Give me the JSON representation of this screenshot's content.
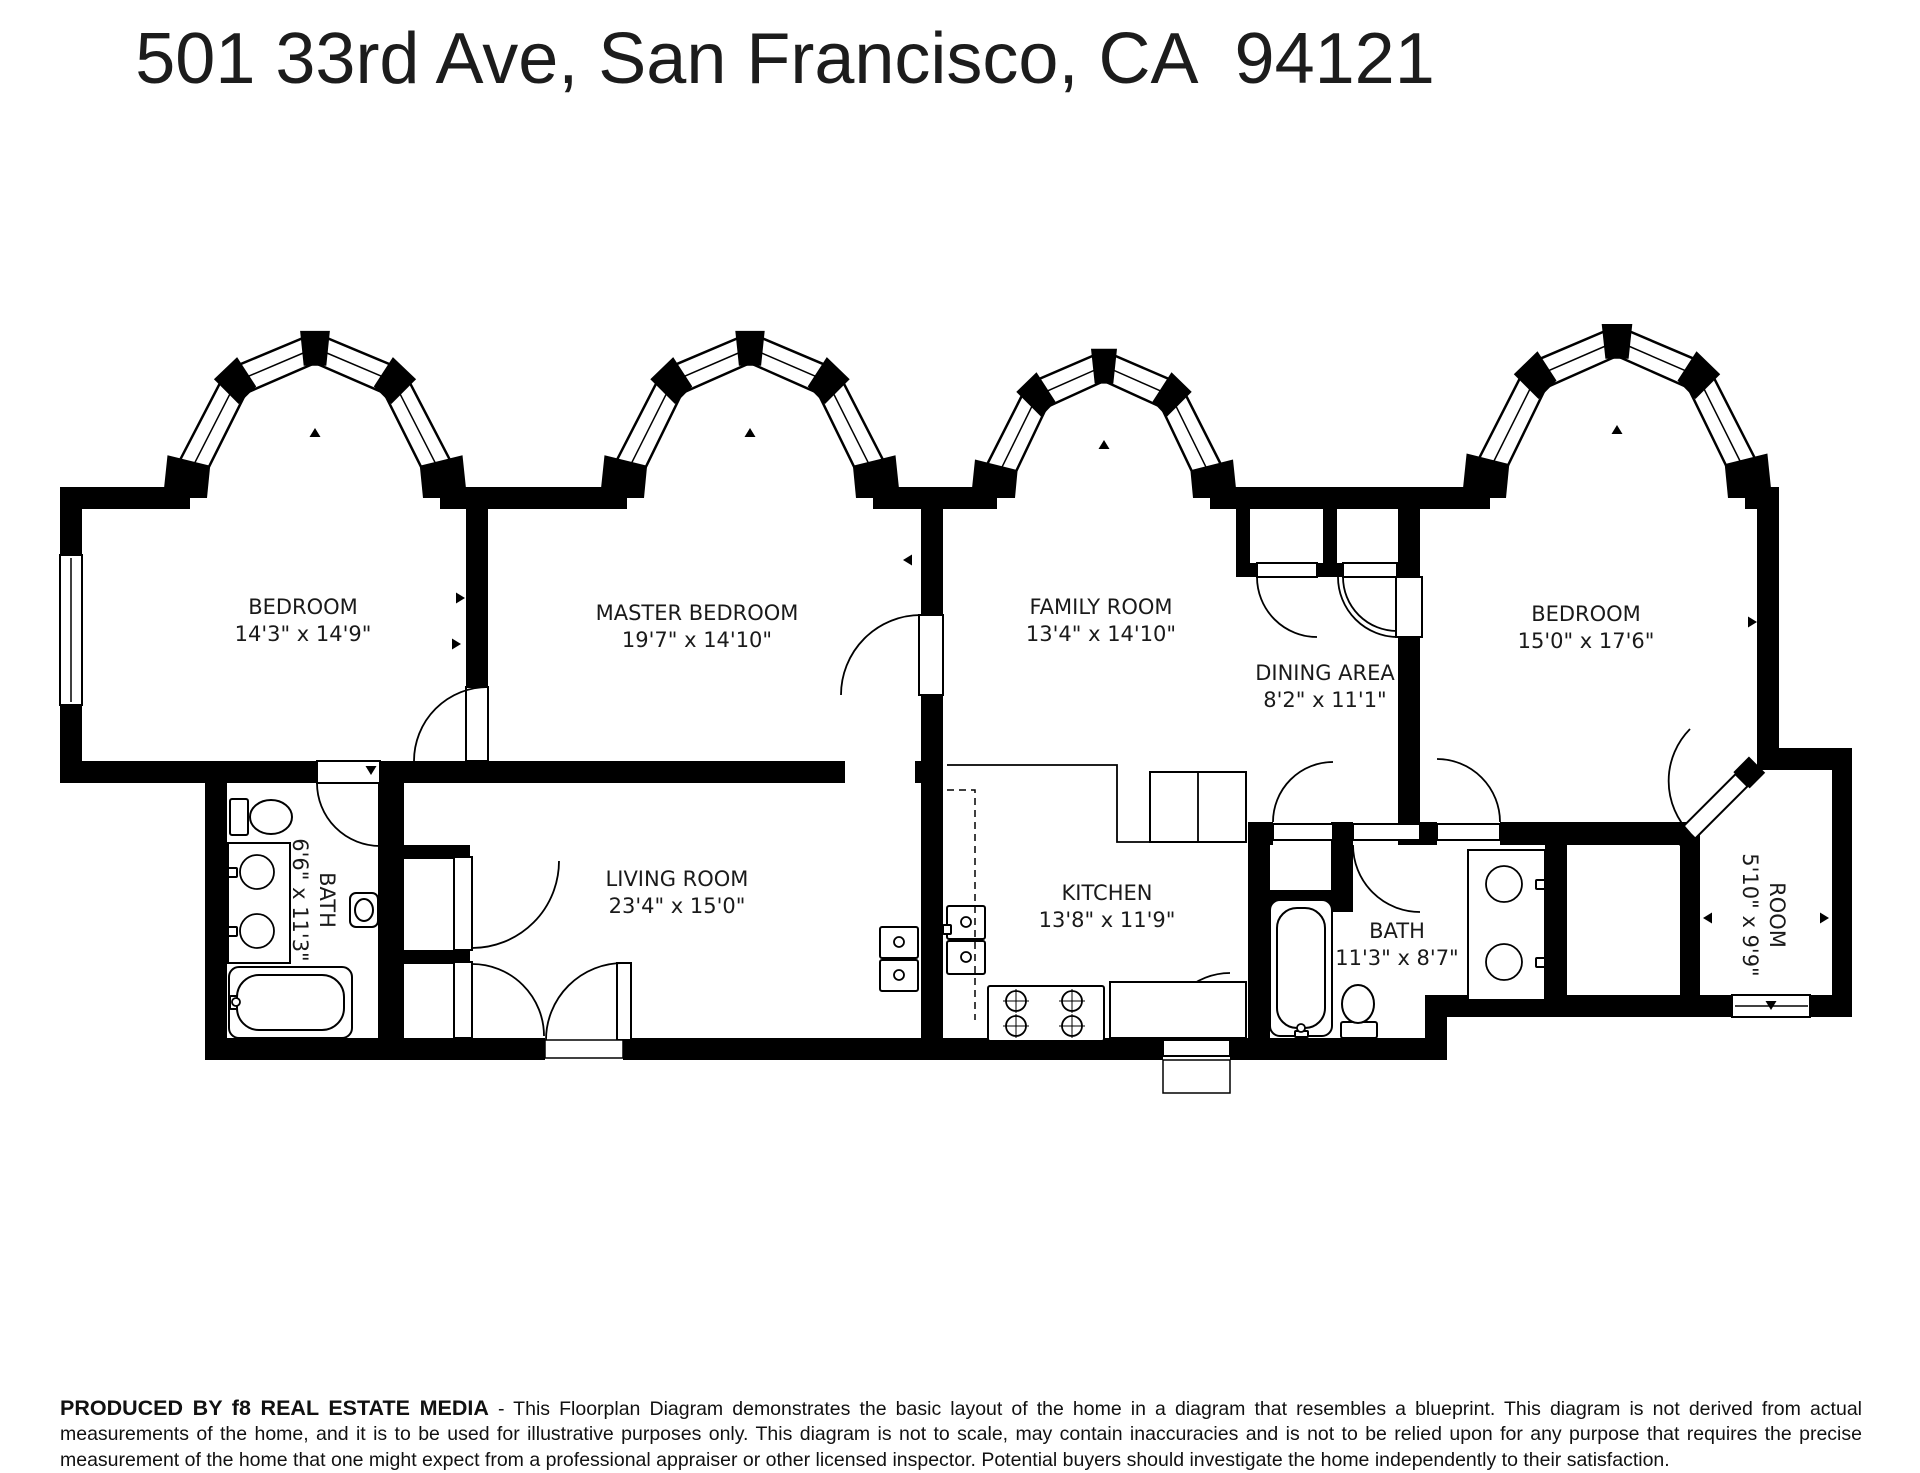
{
  "title": "501 33rd Ave, San Francisco, CA  94121",
  "rooms": {
    "bedroom1": {
      "name": "BEDROOM",
      "dims": "14'3\" x 14'9\""
    },
    "master": {
      "name": "MASTER BEDROOM",
      "dims": "19'7\" x 14'10\""
    },
    "family": {
      "name": "FAMILY ROOM",
      "dims": "13'4\" x 14'10\""
    },
    "dining": {
      "name": "DINING AREA",
      "dims": "8'2\" x 11'1\""
    },
    "bedroom2": {
      "name": "BEDROOM",
      "dims": "15'0\" x 17'6\""
    },
    "bath1": {
      "name": "BATH",
      "dims": "6'6\" x 11'3\""
    },
    "living": {
      "name": "LIVING ROOM",
      "dims": "23'4\" x 15'0\""
    },
    "kitchen": {
      "name": "KITCHEN",
      "dims": "13'8\" x 11'9\""
    },
    "bath2": {
      "name": "BATH",
      "dims": "11'3\" x 8'7\""
    },
    "room": {
      "name": "ROOM",
      "dims": "5'10\" x 9'9\""
    }
  },
  "footer": {
    "producer": "PRODUCED BY f8 REAL ESTATE MEDIA",
    "disclaimer": " - This Floorplan Diagram demonstrates the basic layout of the home in a diagram that resembles a blueprint. This diagram is not derived from actual measurements of the home, and it is to be used for illustrative purposes only. This diagram is not to scale, may contain inaccuracies and is not to be relied upon for any purpose that requires the precise measurement of the home that one might expect from a professional appraiser or other licensed inspector. Potential buyers should investigate the home independently to their satisfaction."
  },
  "colors": {
    "walls": "#000000",
    "background": "#ffffff",
    "text": "#1a1a1a"
  }
}
